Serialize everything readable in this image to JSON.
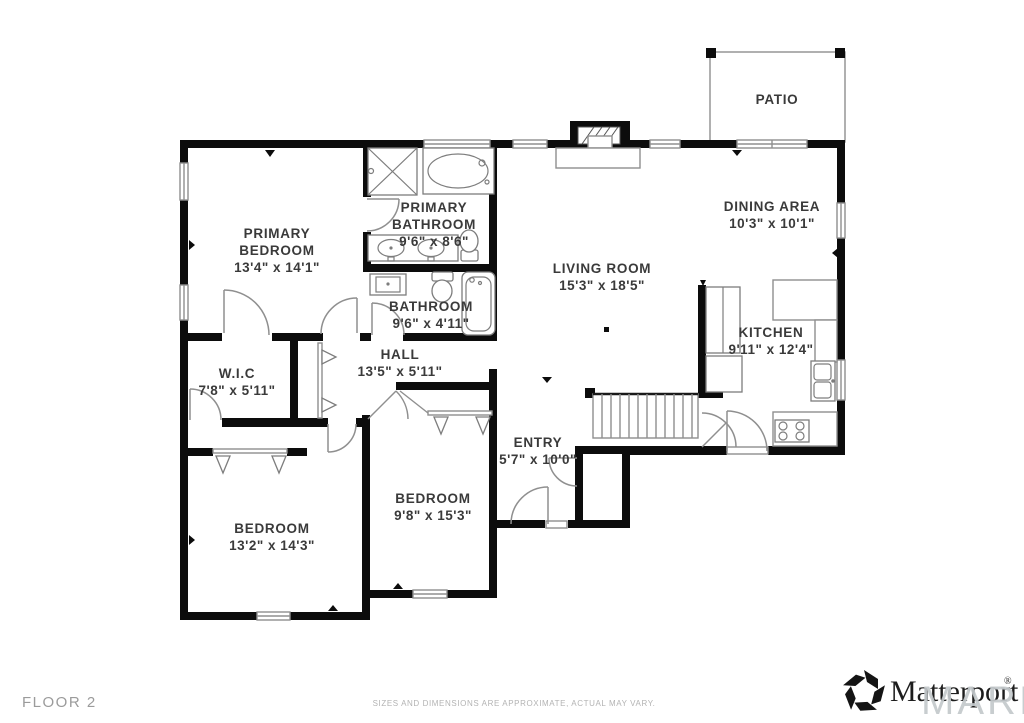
{
  "floor_label": "FLOOR 2",
  "disclaimer": "SIZES AND DIMENSIONS ARE APPROXIMATE, ACTUAL MAY VARY.",
  "watermark": "MARIS",
  "brand": {
    "name": "Matterport",
    "registered": "®"
  },
  "colors": {
    "wall": "#0c0c0c",
    "thin_line": "#8f8f8f",
    "label": "#3a3a3a",
    "muted": "#9b9b9b",
    "watermark": "#c4c9cc"
  },
  "fixtures": [
    "shower-icon",
    "bathtub-icon",
    "double-vanity-icon",
    "toilet-icon",
    "sink-vanity-icon",
    "soaking-tub-icon",
    "fireplace-icon",
    "stairs-icon",
    "kitchen-sink-icon",
    "stove-icon",
    "pantry-icon",
    "closet-hangers-icon",
    "patio-outline",
    "window",
    "door-swing"
  ],
  "rooms": [
    {
      "id": "primary-bedroom",
      "name_lines": [
        "PRIMARY",
        "BEDROOM"
      ],
      "dimensions": "13'4\" x 14'1\""
    },
    {
      "id": "primary-bathroom",
      "name_lines": [
        "PRIMARY",
        "BATHROOM"
      ],
      "dimensions": "9'6\" x 8'6\""
    },
    {
      "id": "bathroom",
      "name_lines": [
        "BATHROOM"
      ],
      "dimensions": "9'6\" x 4'11\""
    },
    {
      "id": "hall",
      "name_lines": [
        "HALL"
      ],
      "dimensions": "13'5\" x 5'11\""
    },
    {
      "id": "wic",
      "name_lines": [
        "W.I.C"
      ],
      "dimensions": "7'8\" x 5'11\""
    },
    {
      "id": "bedroom-left",
      "name_lines": [
        "BEDROOM"
      ],
      "dimensions": "13'2\" x 14'3\""
    },
    {
      "id": "bedroom-middle",
      "name_lines": [
        "BEDROOM"
      ],
      "dimensions": "9'8\" x 15'3\""
    },
    {
      "id": "entry",
      "name_lines": [
        "ENTRY"
      ],
      "dimensions": "5'7\" x 10'0\""
    },
    {
      "id": "living-room",
      "name_lines": [
        "LIVING ROOM"
      ],
      "dimensions": "15'3\" x 18'5\""
    },
    {
      "id": "dining-area",
      "name_lines": [
        "DINING AREA"
      ],
      "dimensions": "10'3\" x 10'1\""
    },
    {
      "id": "kitchen",
      "name_lines": [
        "KITCHEN"
      ],
      "dimensions": "9'11\" x 12'4\""
    },
    {
      "id": "patio",
      "name_lines": [
        "PATIO"
      ],
      "dimensions": ""
    }
  ]
}
